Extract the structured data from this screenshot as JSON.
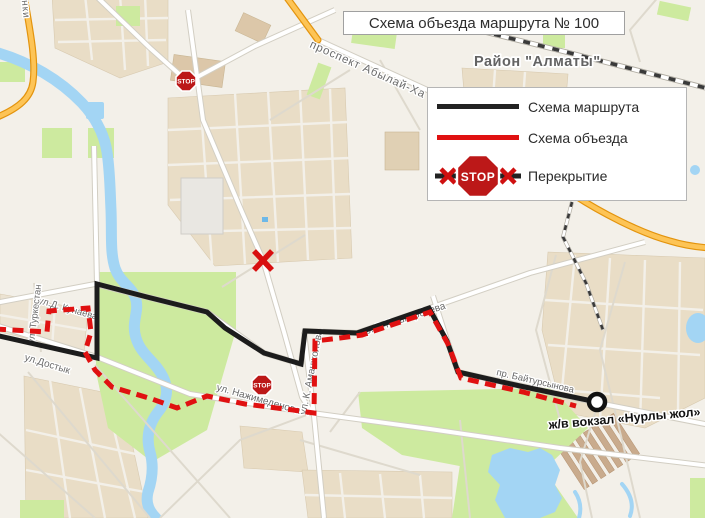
{
  "title": "Схема объезда маршрута № 100",
  "district_label": "Район \"Алматы\"",
  "stop_text": "STOP",
  "legend": {
    "route_label": "Схема маршрута",
    "detour_label": "Схема объезда",
    "closure_label": "Перекрытие"
  },
  "map_labels": {
    "abylai_khan": "проспект Абылай-Ха",
    "kunaev": "ул.Д. Кунаева",
    "turkestan": "ул. Туркестан",
    "dostyk": "ул.Достык",
    "nazhimedenov": "ул. Нажимеденова",
    "amanzholov": "ул. К. Аманжолова",
    "koshkarbaev": "пр. Р. Кошкарбаева",
    "baitursynov": "пр. Байтурсынова",
    "station": "ж/в вокзал «Нурлы жол»",
    "partial_street": "инки"
  },
  "colors": {
    "route": "#1c1c1c",
    "detour": "#e01111",
    "stop_sign": "#bc1818",
    "water": "#a3d5f4",
    "park": "#cdea9f",
    "orange_road": "#fdc456"
  }
}
